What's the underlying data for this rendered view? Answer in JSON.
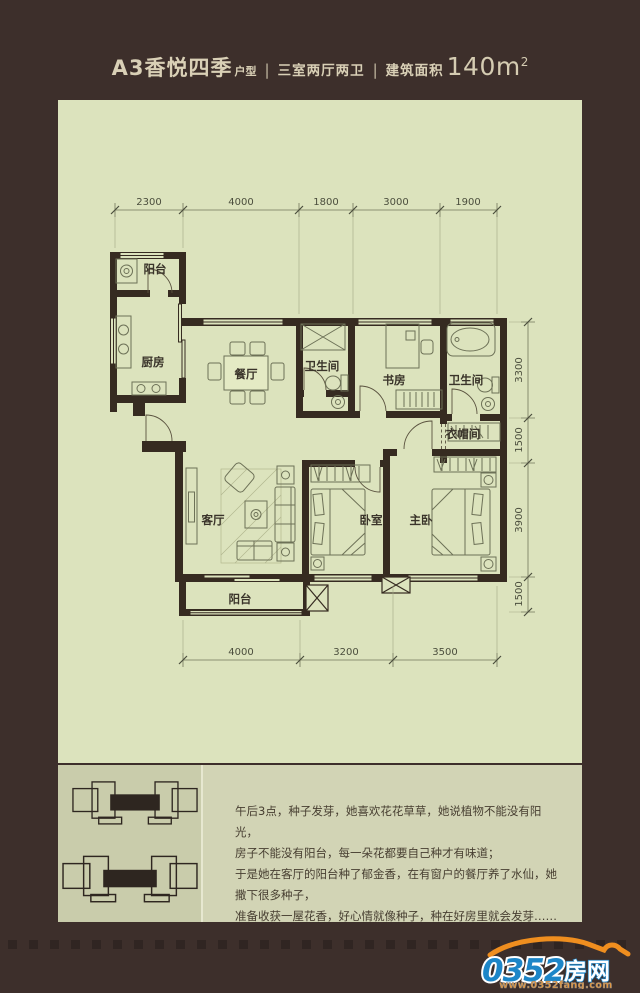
{
  "colors": {
    "background": "#3d2f2b",
    "panel": "#dce3bd",
    "wall": "#362b21",
    "logo_blue": "#1d86c8",
    "logo_orange": "#ef8e1f"
  },
  "header": {
    "name_main": "A3香悦四季",
    "name_suffix": "户型",
    "separator": "|",
    "layout": "三室两厅两卫",
    "area_label": "建筑面积",
    "area_value": "140m",
    "area_sup": "2"
  },
  "floorplan": {
    "rooms": {
      "balcony_top": "阳台",
      "kitchen": "厨房",
      "dining": "餐厅",
      "bath1": "卫生间",
      "study": "书房",
      "bath2": "卫生间",
      "cloakroom": "衣帽间",
      "living": "客厅",
      "bedroom": "卧室",
      "master": "主卧",
      "balcony_bottom": "阳台"
    },
    "dims": {
      "top": [
        "2300",
        "4000",
        "1800",
        "3000",
        "1900"
      ],
      "bottom": [
        "4000",
        "3200",
        "3500"
      ],
      "right": [
        "3300",
        "1500",
        "3900",
        "1500"
      ]
    }
  },
  "story": {
    "line1": "午后3点，种子发芽，她喜欢花花草草，她说植物不能没有阳光，",
    "line2": "房子不能没有阳台，每一朵花都要自己种才有味道；",
    "line3": "于是她在客厅的阳台种了郁金香，在有窗户的餐厅养了水仙，她撒下很多种子，",
    "line4": "准备收获一屋花香，好心情就像种子，种在好房里就会发芽……"
  },
  "logo": {
    "number": "0352",
    "cn": "房网",
    "url": "www.0352fang.com"
  }
}
